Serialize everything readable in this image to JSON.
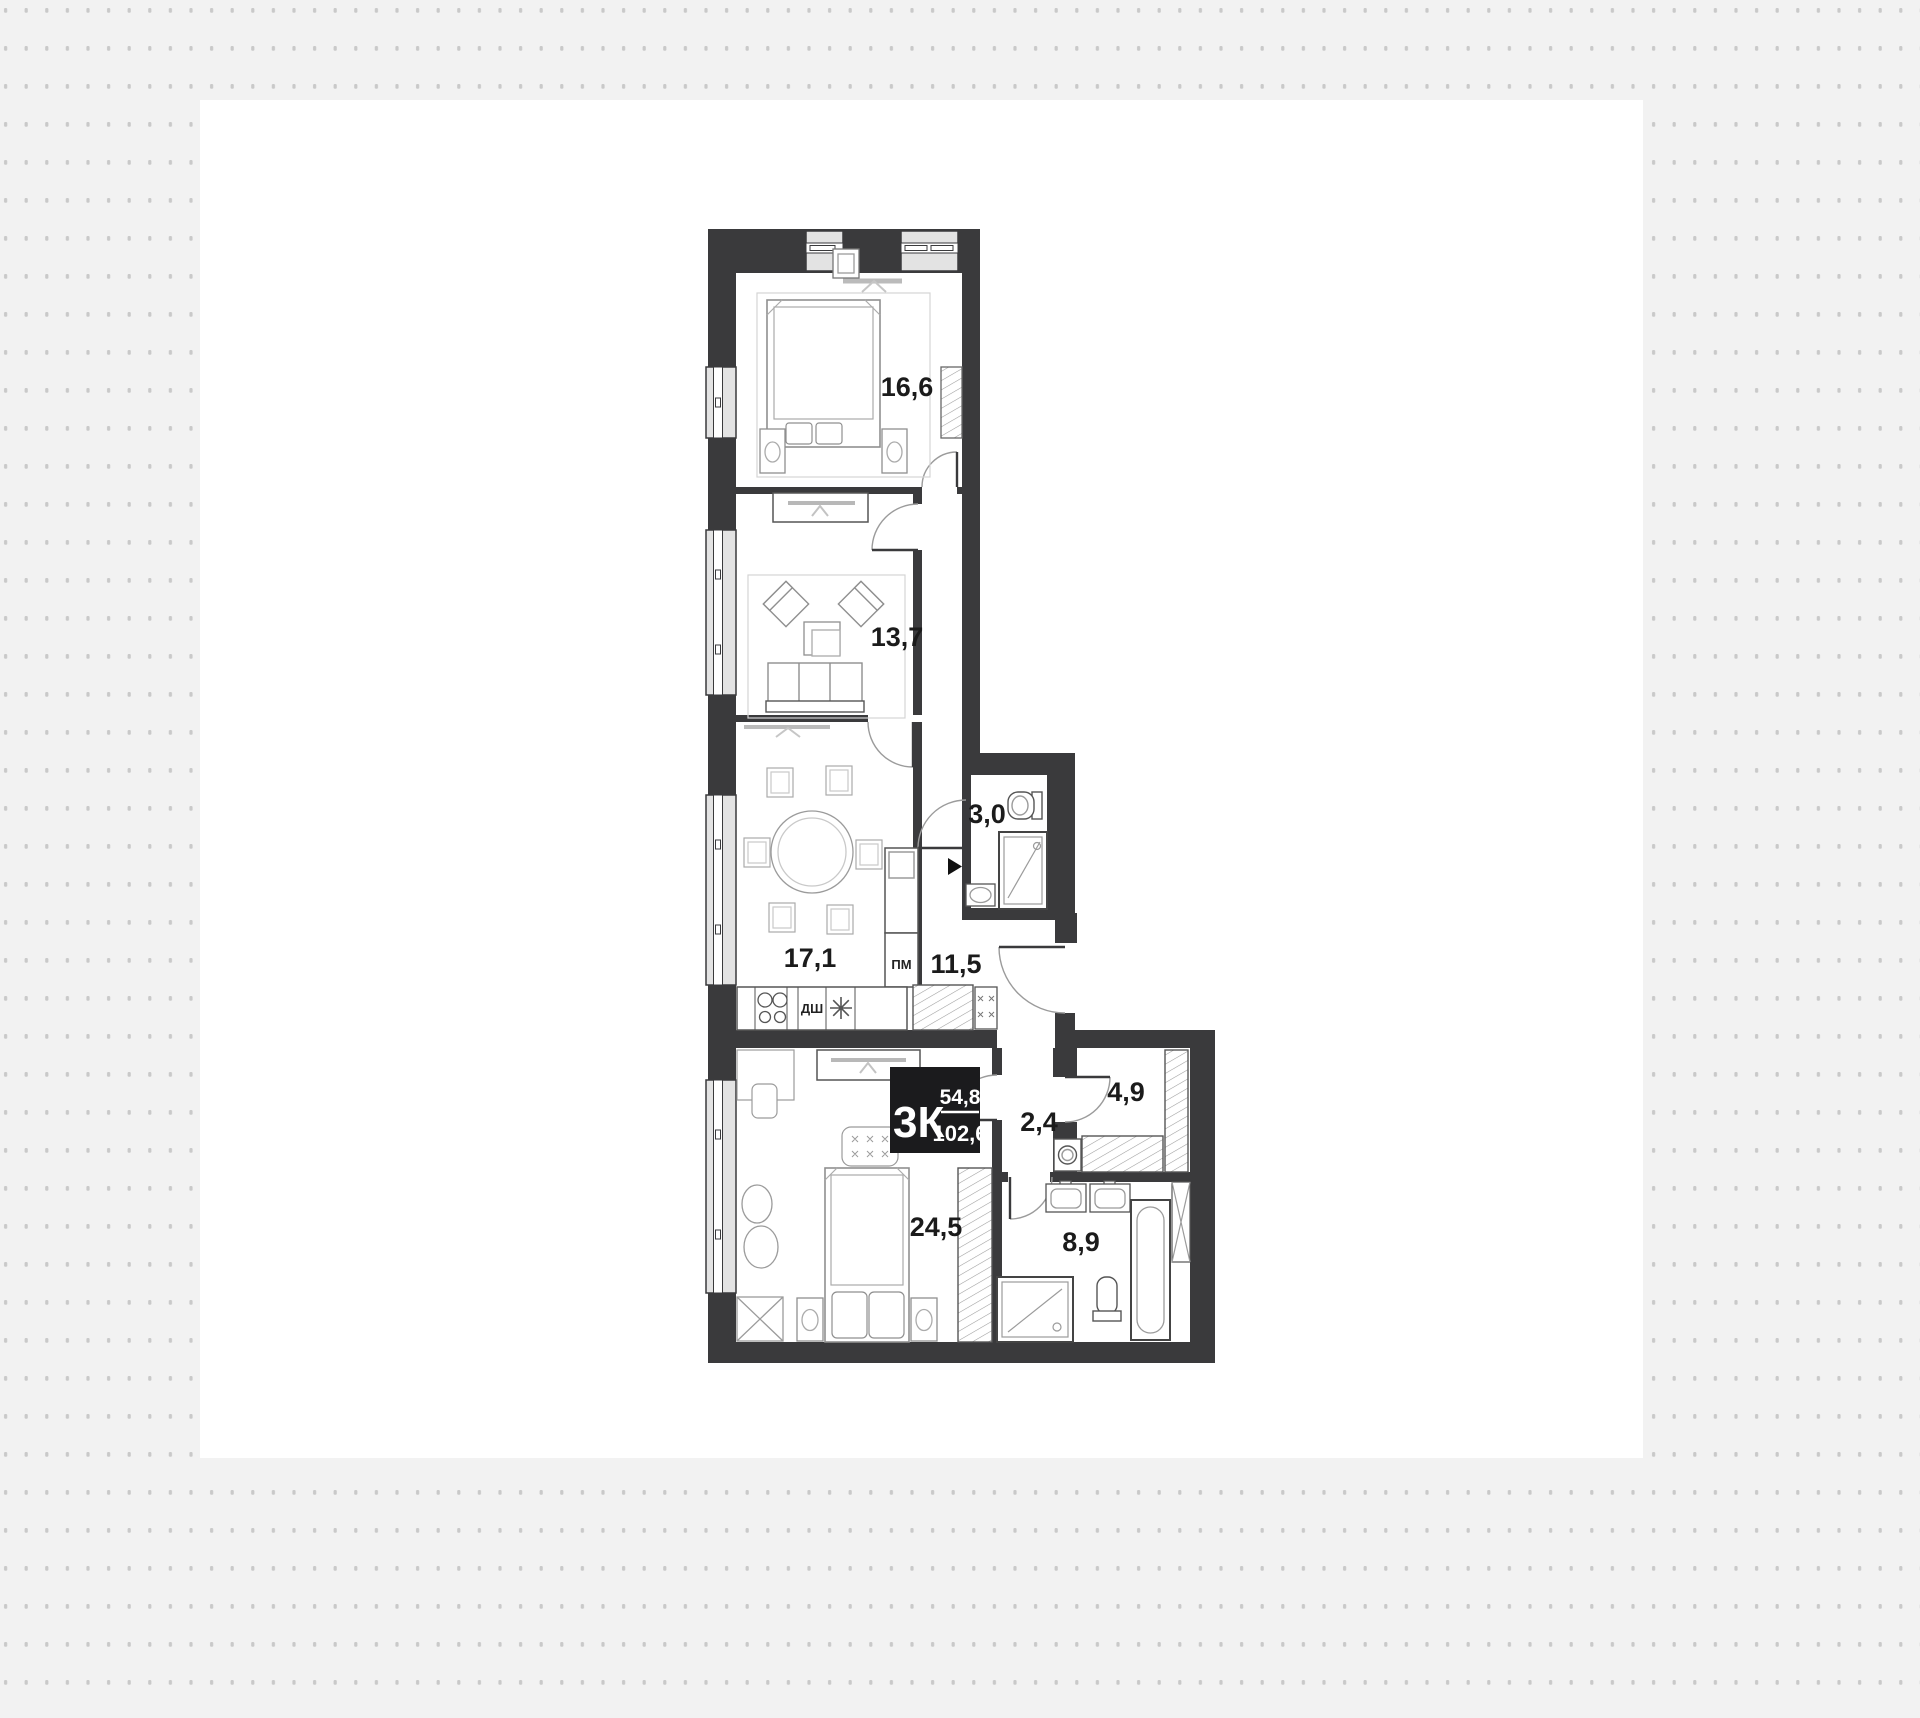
{
  "plan": {
    "summary": {
      "type": "3К",
      "living_area": "54,8",
      "total_area": "102,6"
    },
    "rooms": [
      {
        "name": "bedroom-small",
        "area": "16,6"
      },
      {
        "name": "living-room",
        "area": "13,7"
      },
      {
        "name": "kitchen-dining",
        "area": "17,1"
      },
      {
        "name": "hallway",
        "area": "11,5"
      },
      {
        "name": "wc",
        "area": "3,0"
      },
      {
        "name": "inner-hall",
        "area": "2,4"
      },
      {
        "name": "wardrobe-room",
        "area": "4,9"
      },
      {
        "name": "bedroom-master",
        "area": "24,5"
      },
      {
        "name": "bathroom",
        "area": "8,9"
      }
    ],
    "appliances": {
      "oven": "ДШ",
      "dishwasher": "ПМ"
    },
    "colors": {
      "wall": "#3a3a3c",
      "background": "#f2f2f2",
      "dots": "#c9c9c9",
      "tag_bg": "#1b1b1d"
    }
  }
}
